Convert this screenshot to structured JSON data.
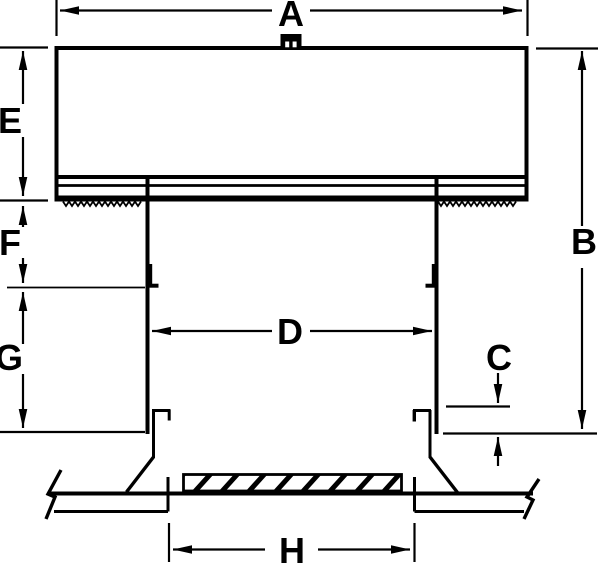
{
  "diagram": {
    "labels": {
      "a": "A",
      "b": "B",
      "c": "C",
      "d": "D",
      "e": "E",
      "f": "F",
      "g": "G",
      "h": "H"
    },
    "colors": {
      "line": "#000000",
      "background": "#ffffff"
    }
  }
}
